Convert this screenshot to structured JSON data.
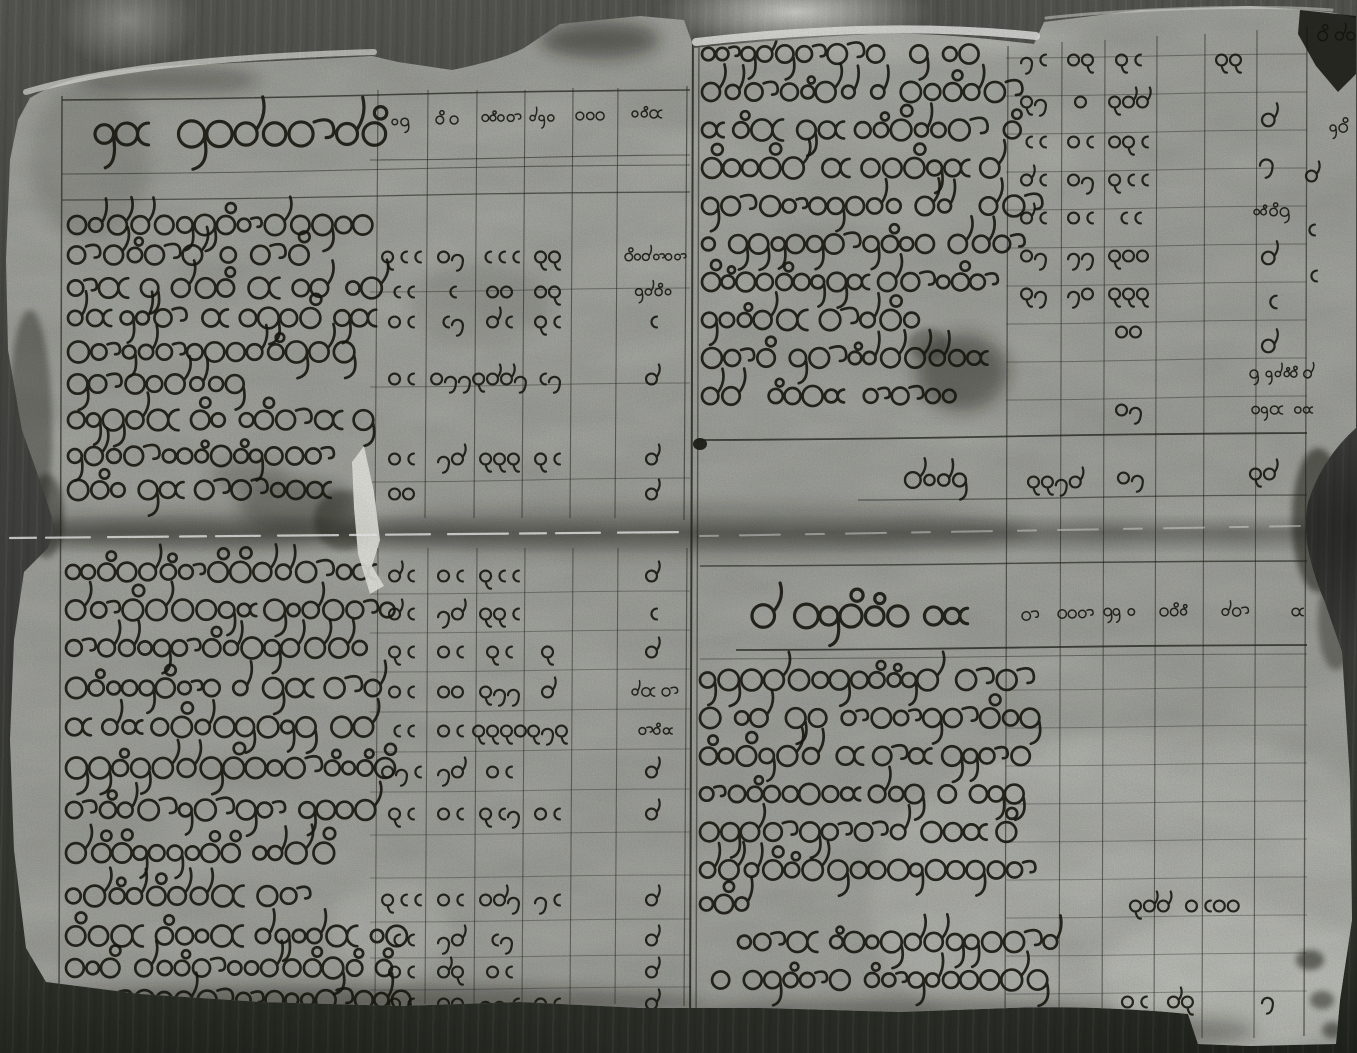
{
  "document": {
    "type": "Black-and-white photograph of a two-page handwritten ledger (parabaik-style account book) in Burmese script",
    "script": "Burmese (Myanmar) round cursive handwriting; entries are Burmese numerals, not machine-readable text",
    "condition": "aged paper, torn ragged edges, horizontal fold crease across the middle, ink stains and dark smudges"
  },
  "photo": {
    "background": "#4a4a46",
    "paper": "#b3b5ae",
    "paper_bright": "#dadbd3",
    "ink": "#191911",
    "rule_color": "#23231c",
    "highlight": "#f2f2ec",
    "stain": "#12120c"
  },
  "gutter": {
    "x1": 693,
    "x2": 699
  },
  "fold": {
    "y": 533,
    "band_top": 514,
    "band_height": 40
  },
  "columns": {
    "left_cell_centers": [
      403,
      452,
      501,
      549,
      595,
      653
    ],
    "right_cell_centers": [
      1035,
      1082,
      1130,
      1180,
      1230,
      1282
    ]
  },
  "verticals": [
    [
      62,
      96,
      998,
      1.5,
      0.65
    ],
    [
      378,
      90,
      518,
      1.1,
      0.55
    ],
    [
      428,
      90,
      518,
      1.1,
      0.55
    ],
    [
      477,
      90,
      518,
      1.1,
      0.55
    ],
    [
      525,
      90,
      518,
      1.1,
      0.55
    ],
    [
      573,
      88,
      518,
      1.1,
      0.55
    ],
    [
      618,
      88,
      518,
      1.1,
      0.55
    ],
    [
      687,
      86,
      520,
      1.2,
      0.6
    ],
    [
      378,
      548,
      1004,
      1.1,
      0.5
    ],
    [
      428,
      548,
      1004,
      1.1,
      0.5
    ],
    [
      477,
      548,
      1004,
      1.1,
      0.5
    ],
    [
      525,
      548,
      1004,
      1.1,
      0.5
    ],
    [
      573,
      548,
      1004,
      1.1,
      0.5
    ],
    [
      618,
      548,
      1004,
      1.1,
      0.5
    ],
    [
      687,
      548,
      1006,
      1.2,
      0.55
    ],
    [
      693,
      20,
      1040,
      2.0,
      0.8
    ],
    [
      699,
      20,
      1040,
      1.4,
      0.55
    ],
    [
      1008,
      46,
      1038,
      1.2,
      0.6
    ],
    [
      1062,
      42,
      1038,
      1.1,
      0.55
    ],
    [
      1105,
      40,
      1038,
      1.1,
      0.55
    ],
    [
      1157,
      36,
      1038,
      1.1,
      0.55
    ],
    [
      1205,
      34,
      1038,
      1.1,
      0.55
    ],
    [
      1257,
      30,
      1038,
      1.1,
      0.55
    ],
    [
      1307,
      26,
      1036,
      1.3,
      0.6
    ]
  ],
  "horizontals": [
    [
      62,
      100,
      690,
      -10,
      1.6,
      0.7
    ],
    [
      370,
      160,
      690,
      -5,
      1.1,
      0.55
    ],
    [
      62,
      174,
      690,
      -9,
      1.1,
      0.5
    ],
    [
      62,
      200,
      690,
      -8,
      1.3,
      0.6
    ],
    [
      370,
      292,
      690,
      -4,
      1.0,
      0.4
    ],
    [
      370,
      387,
      690,
      -4,
      1.0,
      0.4
    ],
    [
      370,
      482,
      690,
      -4,
      1.0,
      0.4
    ],
    [
      370,
      594,
      690,
      -3,
      1.0,
      0.35
    ],
    [
      370,
      633,
      690,
      -3,
      1.0,
      0.35
    ],
    [
      370,
      672,
      690,
      -3,
      1.0,
      0.35
    ],
    [
      370,
      712,
      690,
      -3,
      1.0,
      0.35
    ],
    [
      370,
      752,
      690,
      -3,
      1.0,
      0.35
    ],
    [
      370,
      792,
      690,
      -3,
      1.0,
      0.35
    ],
    [
      370,
      835,
      690,
      -3,
      1.0,
      0.35
    ],
    [
      370,
      878,
      690,
      -3,
      1.0,
      0.35
    ],
    [
      370,
      922,
      690,
      -3,
      1.0,
      0.35
    ],
    [
      370,
      958,
      690,
      -3,
      1.0,
      0.35
    ],
    [
      370,
      990,
      690,
      -3,
      1.0,
      0.35
    ],
    [
      1006,
      58,
      1307,
      -4,
      1.0,
      0.4
    ],
    [
      1006,
      96,
      1307,
      -4,
      1.0,
      0.4
    ],
    [
      1006,
      134,
      1307,
      -4,
      1.0,
      0.4
    ],
    [
      1006,
      172,
      1307,
      -4,
      1.0,
      0.4
    ],
    [
      1006,
      210,
      1307,
      -4,
      1.0,
      0.4
    ],
    [
      1006,
      248,
      1307,
      -4,
      1.0,
      0.4
    ],
    [
      1006,
      286,
      1307,
      -4,
      1.0,
      0.4
    ],
    [
      1006,
      324,
      1307,
      -4,
      1.0,
      0.4
    ],
    [
      1006,
      362,
      1307,
      -4,
      1.0,
      0.4
    ],
    [
      1006,
      400,
      1307,
      -4,
      1.0,
      0.4
    ],
    [
      700,
      440,
      1307,
      -7,
      1.8,
      0.75
    ],
    [
      858,
      500,
      1307,
      -5,
      1.3,
      0.55
    ],
    [
      700,
      566,
      1307,
      -5,
      1.5,
      0.65
    ],
    [
      736,
      650,
      1307,
      -5,
      1.8,
      0.75
    ],
    [
      700,
      659,
      1307,
      -5,
      1.0,
      0.45
    ],
    [
      1006,
      690,
      1307,
      -3,
      1.0,
      0.35
    ],
    [
      1006,
      728,
      1307,
      -3,
      1.0,
      0.35
    ],
    [
      1006,
      766,
      1307,
      -3,
      1.0,
      0.35
    ],
    [
      1006,
      804,
      1307,
      -3,
      1.0,
      0.35
    ],
    [
      1006,
      842,
      1307,
      -3,
      1.0,
      0.35
    ],
    [
      1006,
      880,
      1307,
      -3,
      1.0,
      0.35
    ],
    [
      1006,
      918,
      1307,
      -3,
      1.0,
      0.35
    ],
    [
      1006,
      956,
      1307,
      -3,
      1.0,
      0.35
    ],
    [
      1006,
      994,
      1307,
      -3,
      1.0,
      0.35
    ]
  ],
  "panels": {
    "top_left": {
      "label": "Left page upper half: ruled table, Burmese heading column plus six narrow numeral columns",
      "title": {
        "x": 95,
        "y": 134,
        "len": 282,
        "h": 30
      },
      "header_cells": [
        [
          392,
          122,
          "~2"
        ],
        [
          436,
          120,
          "~3"
        ],
        [
          482,
          118,
          "~4"
        ],
        [
          530,
          118,
          "~3"
        ],
        [
          576,
          116,
          "~3"
        ],
        [
          632,
          114,
          "~4"
        ]
      ],
      "text_rows": [
        [
          68,
          225,
          298
        ],
        [
          68,
          255,
          226
        ],
        [
          68,
          288,
          300
        ],
        [
          68,
          318,
          318
        ],
        [
          68,
          352,
          284
        ],
        [
          68,
          384,
          172
        ],
        [
          68,
          420,
          300
        ],
        [
          68,
          456,
          262
        ],
        [
          68,
          490,
          258
        ]
      ],
      "cell_rows": [
        [
          255,
          [
            "100",
            "23",
            "550",
            "16",
            "",
            "~8"
          ]
        ],
        [
          290,
          [
            "55",
            "5",
            "22",
            "26",
            "",
            "~5"
          ]
        ],
        [
          320,
          [
            "20",
            "58",
            "90",
            "10",
            "",
            "5"
          ]
        ],
        [
          377,
          [
            "25",
            "233",
            "1448",
            "58",
            "",
            "4"
          ]
        ],
        [
          457,
          [
            "25",
            "tk",
            "166",
            "10",
            "",
            "4"
          ]
        ],
        [
          492,
          [
            "22",
            "",
            "",
            "",
            "",
            "4"
          ]
        ]
      ]
    },
    "top_right": {
      "label": "Right page upper half: Burmese entry lines with numeral columns and marginal annotations",
      "text_rows": [
        [
          702,
          54,
          286
        ],
        [
          702,
          92,
          304
        ],
        [
          702,
          130,
          310
        ],
        [
          702,
          168,
          300
        ],
        [
          702,
          206,
          306
        ],
        [
          702,
          244,
          300
        ],
        [
          702,
          282,
          296
        ],
        [
          702,
          320,
          212
        ],
        [
          702,
          358,
          300
        ],
        [
          702,
          396,
          252
        ]
      ],
      "cell_rows": [
        [
          58,
          [
            "30",
            "21",
            "15",
            "",
            "1c",
            ""
          ]
        ],
        [
          100,
          [
            "13",
            "2",
            "144",
            "",
            "",
            ""
          ]
        ],
        [
          140,
          [
            "50",
            "25",
            "215",
            "",
            "",
            ""
          ]
        ],
        [
          178,
          [
            "40",
            "23",
            "100",
            "",
            "",
            ""
          ]
        ],
        [
          216,
          [
            "40",
            "20",
            "50",
            "",
            "",
            ""
          ]
        ],
        [
          254,
          [
            "23",
            "33",
            "122",
            "",
            "",
            ""
          ]
        ],
        [
          292,
          [
            "13",
            "32",
            "111",
            "",
            "",
            ""
          ]
        ],
        [
          330,
          [
            "",
            "",
            "2d",
            "",
            "",
            ""
          ]
        ],
        [
          408,
          [
            "",
            "",
            "2y",
            "",
            "",
            ""
          ]
        ]
      ],
      "summary": {
        "script": [
          905,
          480,
          56,
          17
        ],
        "cells": [
          [
            1028,
            482,
            "1139"
          ],
          [
            1118,
            478,
            "2y"
          ],
          [
            1250,
            474,
            "19"
          ]
        ]
      },
      "annotations": [
        [
          1318,
          36,
          "~6",
          14
        ],
        [
          1330,
          128,
          "~2",
          13
        ],
        [
          1262,
          120,
          "4",
          15
        ],
        [
          1260,
          162,
          "8",
          15
        ],
        [
          1254,
          212,
          "~5",
          11
        ],
        [
          1262,
          258,
          "4",
          15
        ],
        [
          1264,
          302,
          "5",
          15
        ],
        [
          1262,
          346,
          "4",
          15
        ],
        [
          1250,
          374,
          "~8",
          9
        ],
        [
          1252,
          410,
          "~8",
          9
        ],
        [
          1306,
          176,
          "4",
          13
        ],
        [
          1304,
          230,
          "5",
          13
        ],
        [
          1306,
          276,
          "5",
          13
        ]
      ]
    },
    "bottom_left": {
      "label": "Left page lower half: ruled table rows of Burmese entries with numeral columns",
      "text_rows": [
        [
          66,
          572,
          300
        ],
        [
          66,
          610,
          322
        ],
        [
          66,
          648,
          300
        ],
        [
          66,
          688,
          312
        ],
        [
          66,
          727,
          304
        ],
        [
          66,
          768,
          330
        ],
        [
          66,
          810,
          312
        ],
        [
          66,
          853,
          252
        ],
        [
          66,
          896,
          244
        ],
        [
          66,
          936,
          330
        ],
        [
          66,
          968,
          312
        ],
        [
          66,
          1000,
          330
        ]
      ],
      "cell_rows": [
        [
          574,
          [
            "40",
            "25",
            "100",
            "",
            "",
            "4"
          ]
        ],
        [
          612,
          [
            "90",
            "tk",
            "160",
            "",
            "",
            "5"
          ]
        ],
        [
          650,
          [
            "60",
            "20",
            "15",
            "6",
            "",
            "4"
          ]
        ],
        [
          690,
          [
            "20",
            "22",
            "183",
            "4",
            "",
            "~6"
          ]
        ],
        [
          729,
          [
            "50",
            "25",
            "1112",
            "131",
            "",
            "~4"
          ]
        ],
        [
          770,
          [
            "230",
            "34",
            "25",
            "",
            "",
            "4"
          ]
        ],
        [
          812,
          [
            "60",
            "20",
            "108",
            "25",
            "",
            "4"
          ]
        ],
        [
          898,
          [
            "100",
            "20",
            "243",
            "35",
            "",
            "4"
          ]
        ],
        [
          938,
          [
            "50",
            "tk",
            "53",
            "",
            "",
            "4"
          ]
        ],
        [
          970,
          [
            "20",
            "4c",
            "20",
            "",
            "",
            "4"
          ]
        ],
        [
          1002,
          [
            "20",
            "22",
            "335",
            "10",
            "",
            "4"
          ]
        ]
      ]
    },
    "bottom_right": {
      "label": "Right page lower half: heading of a cash-received list and a Burmese paragraph with a few numerals",
      "title": {
        "x": 752,
        "y": 616,
        "len": 226,
        "h": 26
      },
      "header_cells": [
        [
          1022,
          616,
          "~2"
        ],
        [
          1058,
          614,
          "~3"
        ],
        [
          1104,
          612,
          "~4"
        ],
        [
          1160,
          612,
          "~4"
        ],
        [
          1222,
          612,
          "~3"
        ],
        [
          1292,
          612,
          "~2"
        ]
      ],
      "text_rows": [
        [
          700,
          680,
          318
        ],
        [
          700,
          718,
          322
        ],
        [
          700,
          756,
          330
        ],
        [
          700,
          794,
          324
        ],
        [
          700,
          832,
          318
        ],
        [
          700,
          870,
          320
        ],
        [
          700,
          904,
          46
        ],
        [
          738,
          942,
          318
        ],
        [
          700,
          980,
          330
        ]
      ],
      "loose_cells": [
        [
          1130,
          906,
          "144"
        ],
        [
          1186,
          906,
          "2022"
        ],
        [
          1122,
          1002,
          "20"
        ],
        [
          1168,
          1002,
          "4c"
        ],
        [
          1262,
          1000,
          "3"
        ]
      ]
    }
  },
  "artifacts": {
    "paper_path": "M30,98 C70,72 140,66 210,64 C280,61 340,58 372,56 L398,62 L452,70 C480,64 505,58 524,48 L560,24 L640,16 L684,20 L694,48 C730,44 800,38 870,34 C930,32 980,38 1034,44 L1044,22 L1140,10 L1250,6 L1330,12 L1356,18 L1356,428 C1336,446 1318,470 1308,502 C1302,530 1308,562 1324,600 L1342,652 L1350,780 L1352,920 L1340,1000 L1336,1044 L1250,1046 L1198,1044 L1188,1014 C1130,1008 1060,1006 1010,1008 L900,1012 L760,1008 L640,1008 L520,1002 L400,1006 L260,1002 L140,994 L46,982 L26,948 L14,850 L10,740 L14,640 L24,572 L48,548 L56,530 L44,492 L22,430 L8,350 L6,260 L10,160 L18,120 Z",
    "corner_blob": "M1300,10 L1356,16 L1356,74 L1338,92 L1316,66 L1298,34 Z",
    "tear_polygon": "352,462 364,446 374,492 380,540 372,566 384,586 370,594 358,554 354,508",
    "crease_left": {
      "x1": 10,
      "y1": 538,
      "x2": 688,
      "y2": 532
    },
    "crease_right": {
      "x1": 700,
      "y1": 536,
      "x2": 1300,
      "y2": 526
    },
    "top_edge_left": "M26,92 C120,64 250,56 374,52",
    "top_edge_right": "M696,42 C800,30 920,24 1036,36",
    "top_edge_far_right": "M1046,18 C1120,10 1240,4 1332,10",
    "stains": [
      [
        962,
        372,
        46,
        38,
        0.4
      ],
      [
        928,
        344,
        20,
        16,
        0.28
      ],
      [
        700,
        444,
        7,
        6,
        0.85
      ],
      [
        296,
        506,
        58,
        26,
        0.3
      ],
      [
        344,
        520,
        30,
        30,
        0.35
      ],
      [
        250,
        476,
        40,
        16,
        0.2
      ],
      [
        480,
        306,
        70,
        42,
        0.1
      ],
      [
        1318,
        520,
        26,
        72,
        0.5
      ],
      [
        1336,
        620,
        18,
        50,
        0.35
      ],
      [
        360,
        1002,
        340,
        16,
        0.38
      ],
      [
        900,
        1012,
        220,
        12,
        0.32
      ],
      [
        1160,
        1032,
        95,
        16,
        0.3
      ],
      [
        30,
        430,
        22,
        120,
        0.35
      ],
      [
        46,
        516,
        18,
        42,
        0.4
      ],
      [
        90,
        160,
        60,
        80,
        0.12
      ],
      [
        690,
        530,
        340,
        26,
        0.22
      ],
      [
        200,
        530,
        160,
        18,
        0.25
      ],
      [
        600,
        40,
        60,
        18,
        0.45
      ],
      [
        170,
        80,
        90,
        14,
        0.3
      ],
      [
        1310,
        960,
        14,
        10,
        0.5
      ],
      [
        1322,
        1000,
        12,
        9,
        0.45
      ],
      [
        1332,
        1030,
        10,
        8,
        0.45
      ]
    ],
    "shine": [
      [
        1150,
        900,
        280,
        170,
        0.3
      ],
      [
        1240,
        980,
        140,
        70,
        0.35
      ],
      [
        560,
        240,
        220,
        130,
        0.08
      ],
      [
        900,
        140,
        180,
        90,
        0.1
      ],
      [
        390,
        930,
        60,
        50,
        0.25
      ],
      [
        860,
        46,
        170,
        14,
        0.35
      ],
      [
        1000,
        40,
        80,
        10,
        0.25
      ]
    ]
  }
}
